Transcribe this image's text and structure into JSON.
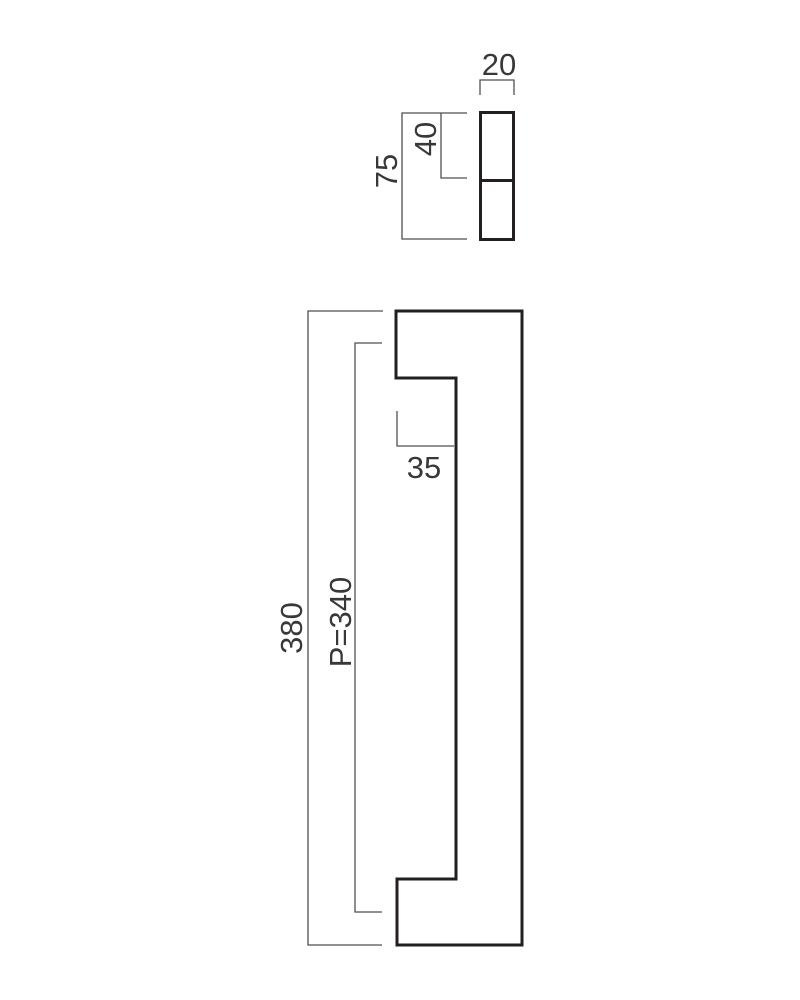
{
  "colors": {
    "background": "#ffffff",
    "object_line": "#231f20",
    "dimension_line": "#514f50",
    "label_text": "#39373a"
  },
  "section_view": {
    "width_label": "20",
    "top_segment_label": "40",
    "height_label": "75"
  },
  "front_view": {
    "overall_height_label": "380",
    "centers_label": "P=340",
    "foot_depth_label": "35"
  }
}
